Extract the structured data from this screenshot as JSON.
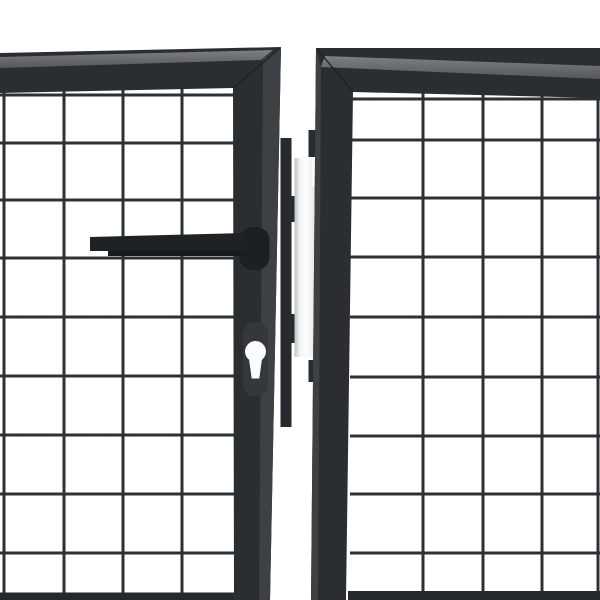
{
  "image": {
    "type": "product-photo",
    "subject": "Close-up of an anthracite grey steel mesh double garden gate: left leaf with lever handle and euro-cylinder keyhole, right leaf, white hinge post in the centre gap",
    "background": "#ffffff"
  },
  "colors": {
    "background": "#ffffff",
    "frame": "#2b2e31",
    "frame_bevel": "#3e4144",
    "band_light": "#7d8082",
    "band_dark": "#55585a",
    "mesh_wire": "#2e3134",
    "handle": "#1f2225",
    "handle_dark": "#191b1e",
    "boss": "#1d2023",
    "escutcheon": "#34373b",
    "lock_strip": "#27292c",
    "bracket": "#292c2f",
    "bottom_bar": "#26292c",
    "keyhole": "#fcfcfc",
    "miter": "#1d1f22",
    "post_edge": "#bfc1c2",
    "post_mid": "#f4f5f5",
    "post_bright": "#fdfefe",
    "post_right": "#eff0f0",
    "sliver_from": "#e7e8e8",
    "sliver_to": "#f7f8f8"
  },
  "scene": {
    "wire_width": 3,
    "gates": [
      {
        "id": "mesh-left",
        "name": "left-gate-mesh",
        "verticals": [
          4,
          64,
          123,
          182,
          241
        ],
        "v_from": 86,
        "v_to": 600,
        "horizontals": [
          95,
          143,
          200,
          258,
          317,
          376,
          435,
          494,
          553
        ],
        "h_from": 0,
        "h_to": 238
      },
      {
        "id": "mesh-right",
        "name": "right-gate-mesh",
        "verticals": [
          423,
          483,
          542,
          598
        ],
        "v_from": 90,
        "v_to": 600,
        "horizontals": [
          99,
          140,
          198,
          257,
          317,
          377,
          436,
          494,
          553
        ],
        "h_from": 350,
        "h_to": 600
      }
    ]
  }
}
